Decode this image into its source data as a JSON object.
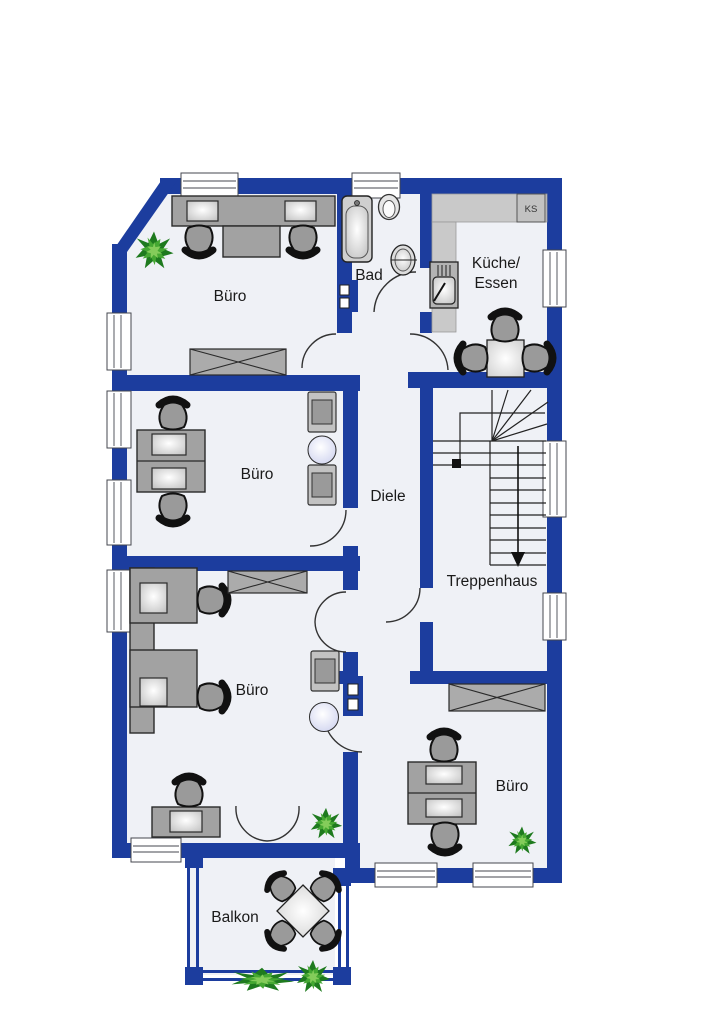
{
  "plan": {
    "rooms": {
      "buero_top": {
        "label": "Büro"
      },
      "bad": {
        "label": "Bad"
      },
      "kueche": {
        "label_line1": "Küche/",
        "label_line2": "Essen"
      },
      "buero_mid": {
        "label": "Büro"
      },
      "diele": {
        "label": "Diele"
      },
      "treppenhaus": {
        "label": "Treppenhaus"
      },
      "buero_bottom_left": {
        "label": "Büro"
      },
      "buero_bottom_right": {
        "label": "Büro"
      },
      "balkon": {
        "label": "Balkon"
      }
    },
    "labels": {
      "fridge": "KS"
    },
    "colors": {
      "wall_blue": "#1c3d9e",
      "floor": "#eff1f6",
      "background": "#ffffff",
      "furniture_gray": "#a2a2a2",
      "counter_gray": "#c9c9c9",
      "side_table_lavender": "#e2e4f5",
      "plant_green_dark": "#1e7a1e",
      "plant_green_light": "#84cc5a",
      "line_dark": "#222222"
    }
  }
}
